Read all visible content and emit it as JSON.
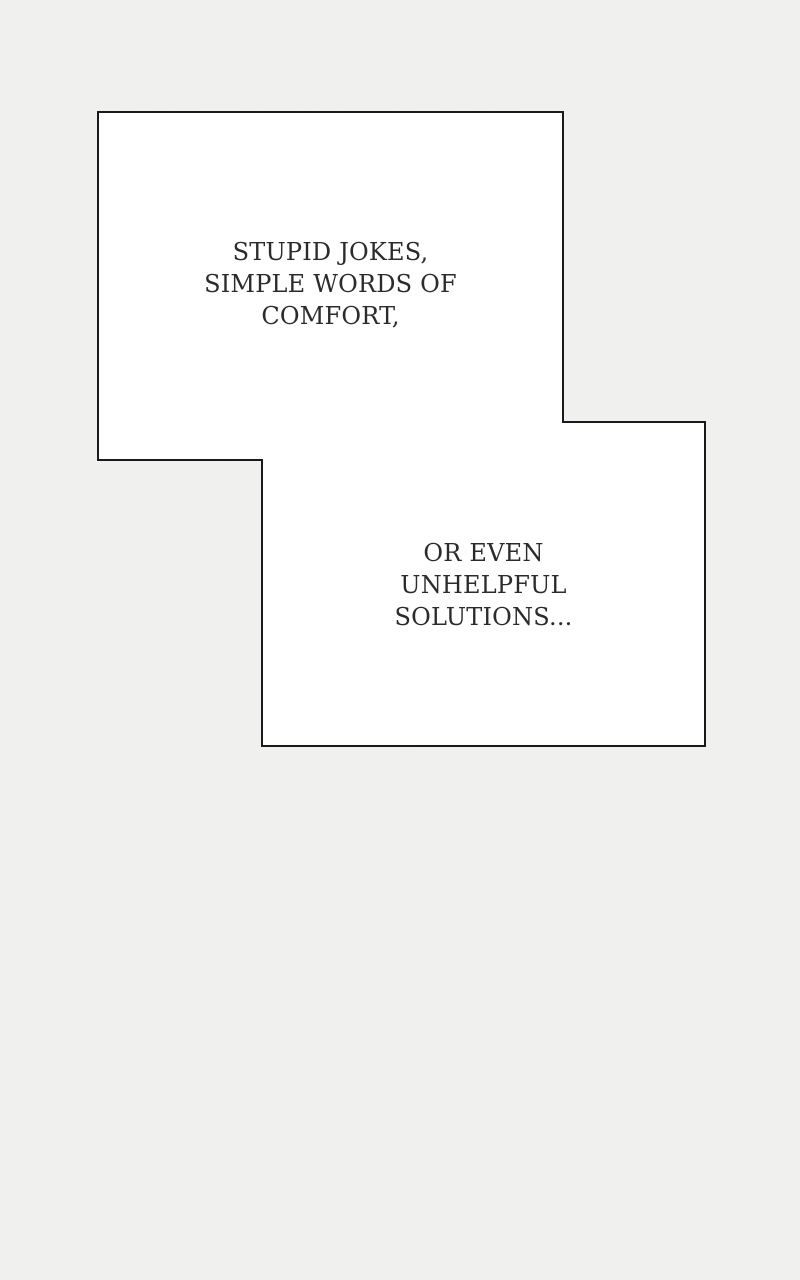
{
  "page": {
    "background_color": "#f1f1ef",
    "panel_fill_color": "#ffffff",
    "panel_border_color": "#1a1a1a",
    "text_color": "#2b2b2b"
  },
  "speech_boxes": [
    {
      "name": "speech-box-1",
      "lines": [
        "STUPID JOKES,",
        "SIMPLE WORDS OF",
        "COMFORT,"
      ]
    },
    {
      "name": "speech-box-2",
      "lines": [
        "OR EVEN",
        "UNHELPFUL",
        "SOLUTIONS..."
      ]
    }
  ]
}
